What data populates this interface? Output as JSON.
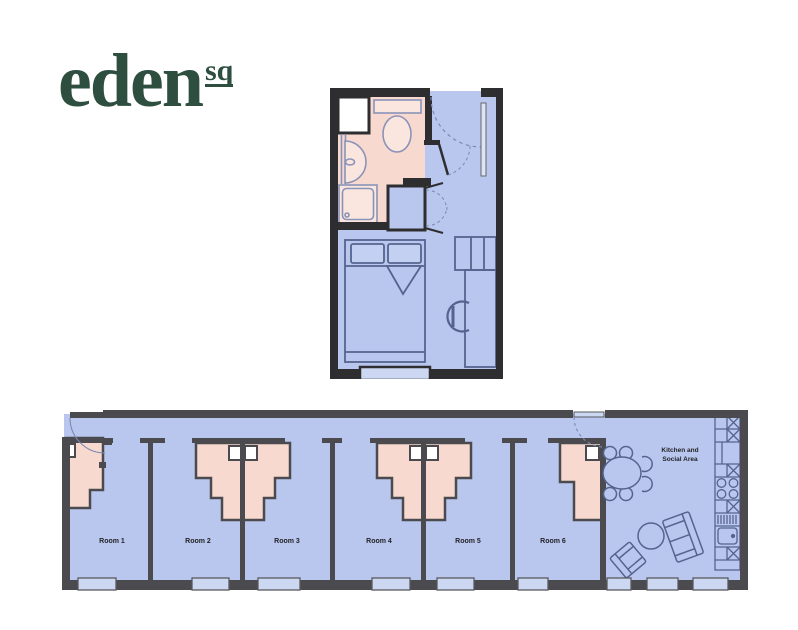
{
  "logo": {
    "text": "eden",
    "superscript": "sq"
  },
  "studio_plan": {
    "title": ""
  },
  "cluster_plan": {
    "rooms": [
      {
        "label": "Room 1"
      },
      {
        "label": "Room 2"
      },
      {
        "label": "Room 3"
      },
      {
        "label": "Room 4"
      },
      {
        "label": "Room 5"
      },
      {
        "label": "Room 6"
      }
    ],
    "kitchen_label": {
      "line1": "Kitchen and",
      "line2": "Social Area"
    }
  },
  "colors": {
    "logo_green": "#2e4e40",
    "room_fill": "#b9c7ee",
    "ensuite_fill": "#f7d9cf",
    "fixture_fill": "#fae6de",
    "wall_dark_studio": "#2e2e30",
    "wall_gray_cluster": "#4b4b4f",
    "furniture_line": "#55648e",
    "window_fill": "#ccd7f2"
  }
}
